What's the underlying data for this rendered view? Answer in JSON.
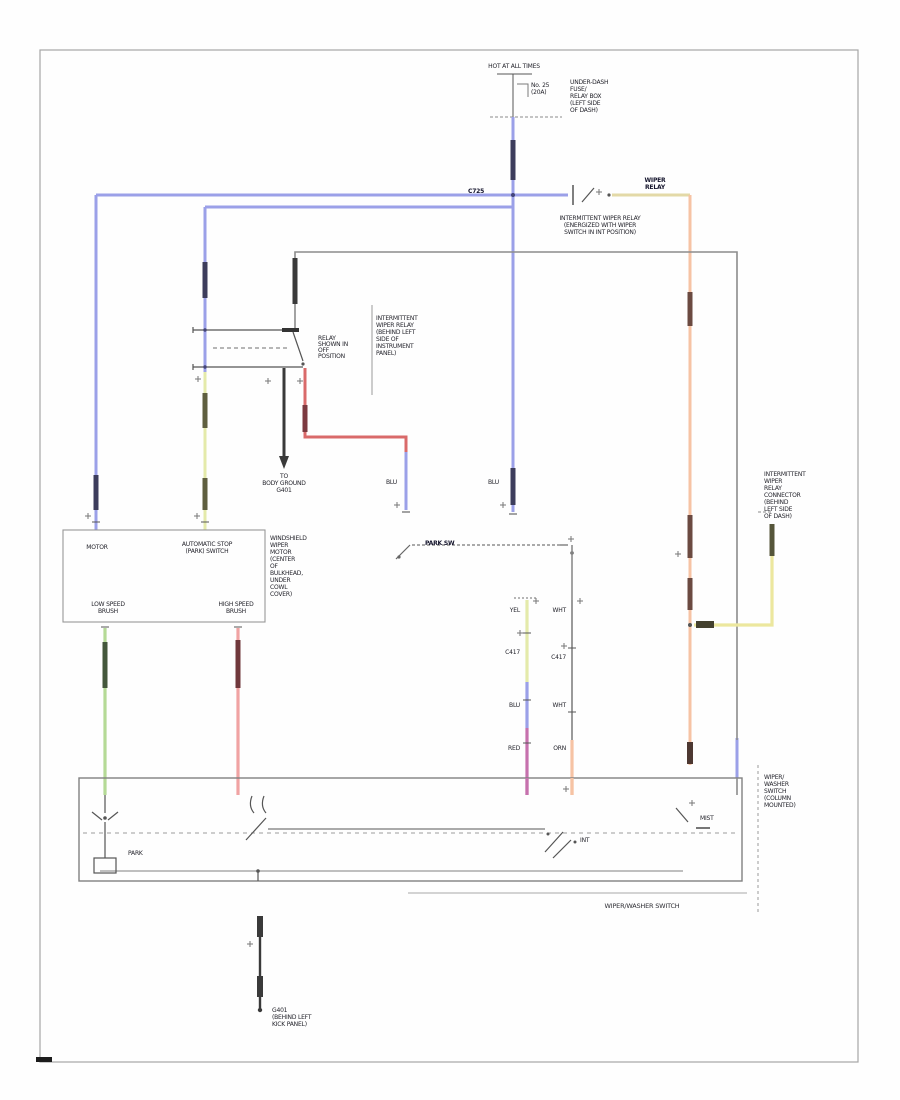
{
  "diagram": {
    "caption": "WIPER/WASHER SWITCH",
    "colors": {
      "wire_blue": "#9ba0e8",
      "wire_blue_connector": "#3d3d5c",
      "wire_yellow": "#e4eaaa",
      "wire_green": "#b5da96",
      "wire_pink_red": "#f0a3a3",
      "wire_bright_red": "#d96a6a",
      "wire_magenta": "#c671ad",
      "wire_orange": "#f6c3a4",
      "wire_tan": "#e3d9a7",
      "wire_black": "#3a3a3a",
      "line_gray": "#868686",
      "text": "#23232b"
    },
    "power": {
      "hot": "HOT AT ALL TIMES",
      "fuse_no": "No. 25",
      "fuse_amp": "(20A)",
      "fusebox": [
        "UNDER-DASH",
        "FUSE/",
        "RELAY BOX",
        "(LEFT SIDE",
        "OF DASH)"
      ]
    },
    "relay_top": {
      "code": "C725",
      "wire_label": [
        "WIPER",
        "RELAY"
      ],
      "caption": [
        "INTERMITTENT WIPER RELAY",
        "(ENERGIZED WITH WIPER",
        "SWITCH IN INT POSITION)"
      ]
    },
    "int_relay": {
      "note": [
        "RELAY",
        "SHOWN IN",
        "OFF",
        "POSITION"
      ],
      "name": [
        "INTERMITTENT",
        "WIPER RELAY",
        "(BEHIND LEFT",
        "SIDE OF",
        "INSTRUMENT",
        "PANEL)"
      ],
      "ground": [
        "TO",
        "BODY GROUND",
        "G401"
      ]
    },
    "park_switch_label": "PARK SW",
    "codes": {
      "blu_a": "BLU",
      "blu_b": "BLU",
      "lad_a1": "YEL",
      "lad_a2": "C417",
      "lad_a3": "BLU",
      "lad_a4": "RED",
      "lad_b1": "WHT",
      "lad_b2": "C417",
      "lad_b3": "WHT",
      "lad_b4": "ORN"
    },
    "motor": {
      "t1": "MOTOR",
      "t2": [
        "AUTOMATIC STOP",
        "(PARK) SWITCH"
      ],
      "b1": [
        "LOW SPEED",
        "BRUSH"
      ],
      "b2": [
        "HIGH SPEED",
        "BRUSH"
      ],
      "name": [
        "WINDSHIELD",
        "WIPER",
        "MOTOR",
        "(CENTER",
        "OF",
        "BULKHEAD,",
        "UNDER",
        "COWL",
        "COVER)"
      ]
    },
    "right_connector": [
      "INTERMITTENT",
      "WIPER",
      "RELAY",
      "CONNECTOR",
      "(BEHIND",
      "LEFT SIDE",
      "OF DASH)"
    ],
    "switch_box": {
      "park": "PARK",
      "int": "INT",
      "mist": "MIST",
      "column": [
        "WIPER/",
        "WASHER",
        "SWITCH",
        "(COLUMN",
        "MOUNTED)"
      ]
    },
    "ground_g401": [
      "G401",
      "(BEHIND LEFT",
      "KICK PANEL)"
    ]
  }
}
